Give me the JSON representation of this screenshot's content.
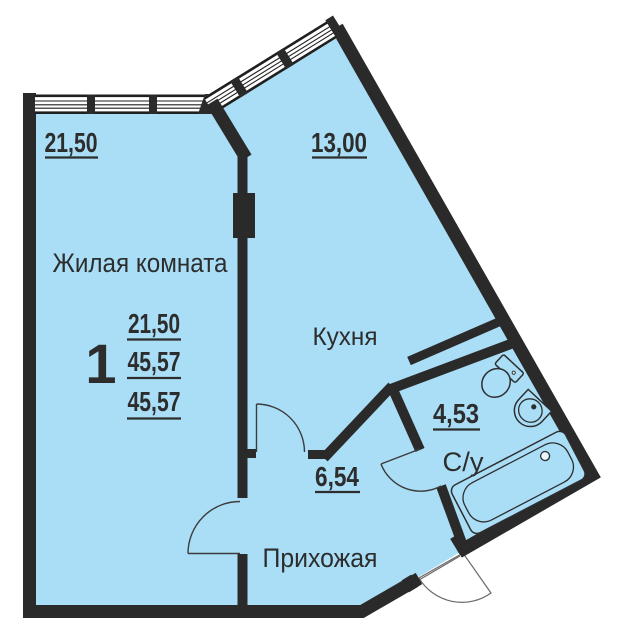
{
  "plan": {
    "type": "apartment-floor-plan",
    "rooms": {
      "living": {
        "label": "Жилая комната",
        "area": "21,50"
      },
      "kitchen": {
        "label": "Кухня",
        "area": "13,00"
      },
      "hallway": {
        "label": "Прихожая",
        "area": "6,54"
      },
      "bathroom": {
        "label": "С/у",
        "area": "4,53"
      }
    },
    "summary": {
      "rooms_count": "1",
      "values": [
        "21,50",
        "45,57",
        "45,57"
      ]
    }
  },
  "colors": {
    "floor": "#a9def6",
    "wall": "#2a2a2a",
    "text": "#2d2d2d",
    "outside": "#ffffff"
  }
}
